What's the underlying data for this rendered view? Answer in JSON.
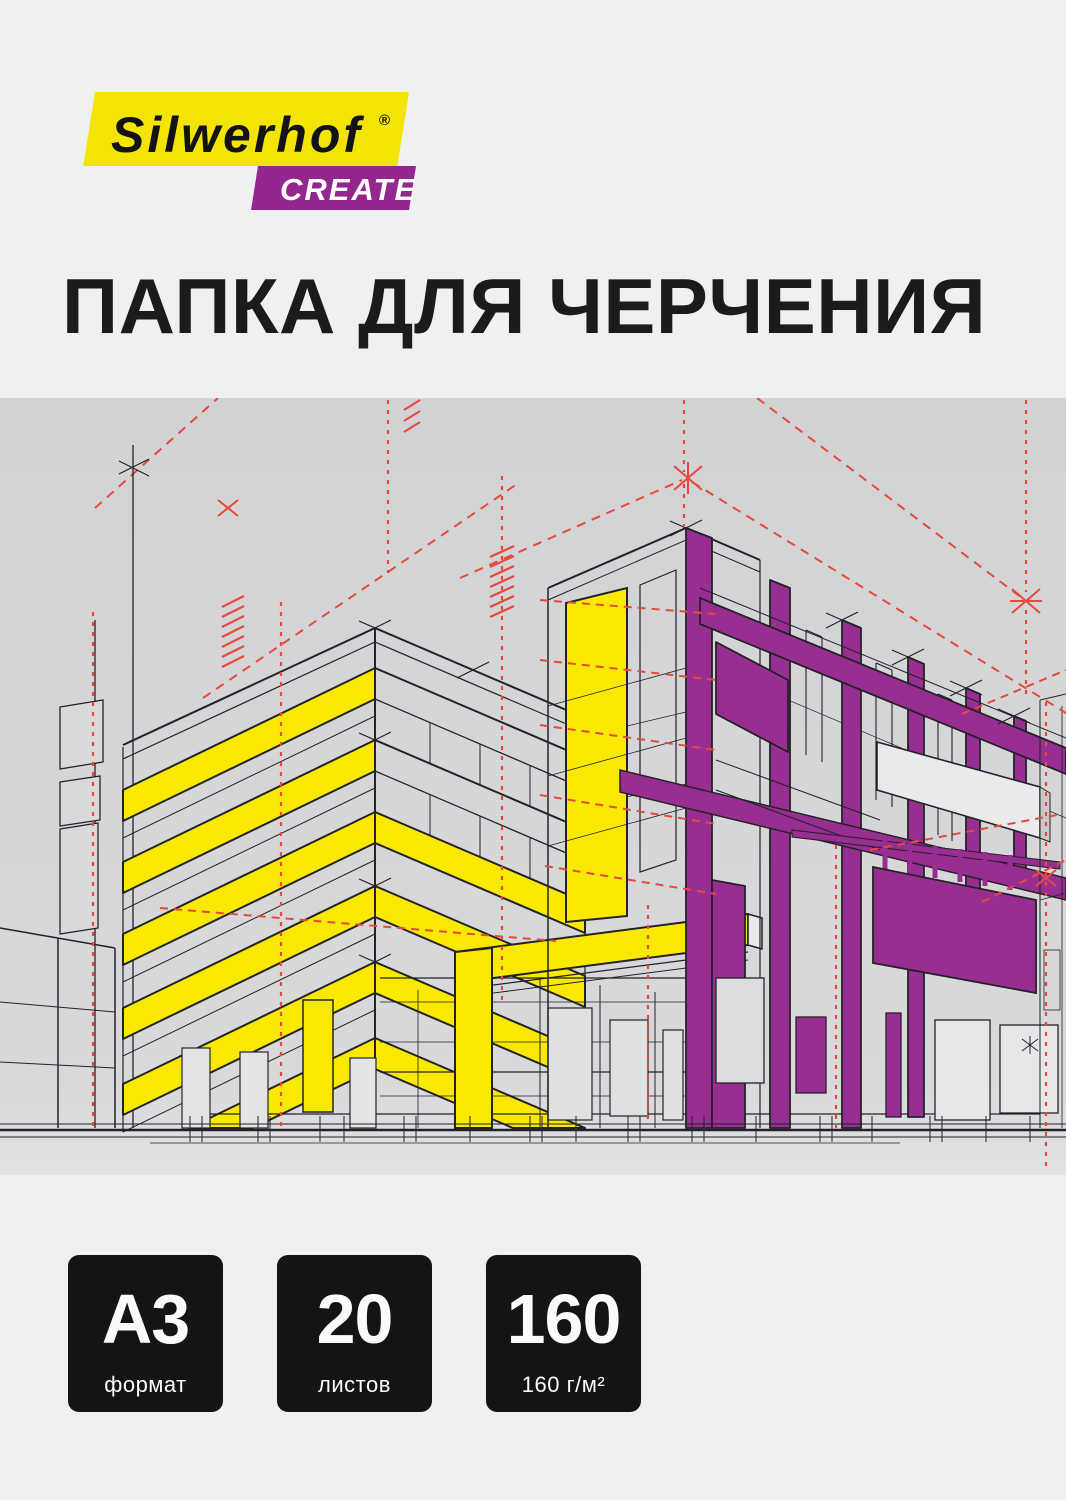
{
  "brand": {
    "name": "Silwerhof",
    "reg_mark": "®",
    "line": "CREATE"
  },
  "title": "ПАПКА ДЛЯ ЧЕРЧЕНИЯ",
  "badges": [
    {
      "value": "A3",
      "label": "формат"
    },
    {
      "value": "20",
      "label": "листов"
    },
    {
      "value": "160",
      "label": "160 г/м²"
    }
  ],
  "colors": {
    "page_background": "#eff0f0",
    "drawing_background": "#d2d3d5",
    "brand_yellow": "#f2e404",
    "brand_purple": "#93278f",
    "drawing_yellow": "#f9e800",
    "drawing_purple": "#982d92",
    "construction_red": "#e8493c",
    "line_black": "#232327",
    "badge_black": "#141416"
  },
  "illustration": {
    "name": "architectural-perspective-blueprint",
    "elements": "two buildings in two-point perspective, yellow floor bands, purple pillars and beams, red dashed construction lines"
  }
}
